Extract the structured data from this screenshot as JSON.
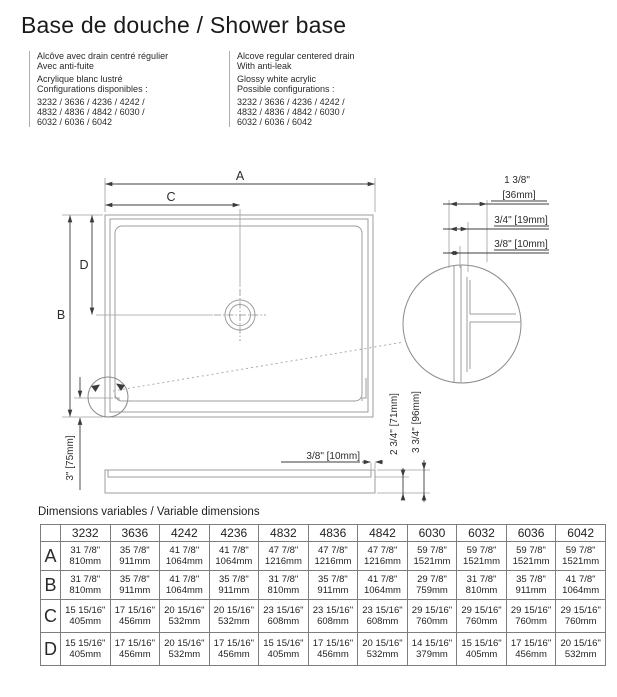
{
  "header": {
    "title": "Base de douche / Shower base",
    "col_fr": {
      "lines": [
        "Alcôve avec drain centré régulier",
        "Avec anti-fuite",
        "Acrylique blanc lustré",
        "Configurations disponibles :",
        "3232 / 3636 / 4236 / 4242 /",
        "4832 / 4836 / 4842 / 6030 /",
        "6032 / 6036 / 6042"
      ]
    },
    "col_en": {
      "lines": [
        "Alcove regular centered drain",
        "With anti-leak",
        "Glossy white acrylic",
        "Possible configurations :",
        "3232 / 3636 / 4236 / 4242 /",
        "4832 / 4836 / 4842 / 6030 /",
        "6032 / 6036 / 6042"
      ]
    }
  },
  "diagram": {
    "labels": {
      "a": "A",
      "b": "B",
      "c": "C",
      "d": "D"
    },
    "detail": {
      "dim1_top": "1 3/8\"",
      "dim1_bottom": "[36mm]",
      "dim2": "3/4\" [19mm]",
      "dim3": "3/8\" [10mm]"
    },
    "side": {
      "lip": "3/8\" [10mm]",
      "left": "3\" [75mm]",
      "inner": "2 3/4\" [71mm]",
      "outer": "3 3/4\" [96mm]"
    }
  },
  "table": {
    "caption": "Dimensions variables / Variable dimensions",
    "columns": [
      "3232",
      "3636",
      "4242",
      "4236",
      "4832",
      "4836",
      "4842",
      "6030",
      "6032",
      "6036",
      "6042"
    ],
    "rows": [
      {
        "label": "A",
        "cells": [
          {
            "in": "31 7/8\"",
            "mm": "810mm"
          },
          {
            "in": "35 7/8\"",
            "mm": "911mm"
          },
          {
            "in": "41 7/8\"",
            "mm": "1064mm"
          },
          {
            "in": "41 7/8\"",
            "mm": "1064mm"
          },
          {
            "in": "47 7/8\"",
            "mm": "1216mm"
          },
          {
            "in": "47 7/8\"",
            "mm": "1216mm"
          },
          {
            "in": "47 7/8\"",
            "mm": "1216mm"
          },
          {
            "in": "59 7/8\"",
            "mm": "1521mm"
          },
          {
            "in": "59 7/8\"",
            "mm": "1521mm"
          },
          {
            "in": "59 7/8\"",
            "mm": "1521mm"
          },
          {
            "in": "59 7/8\"",
            "mm": "1521mm"
          }
        ]
      },
      {
        "label": "B",
        "cells": [
          {
            "in": "31 7/8\"",
            "mm": "810mm"
          },
          {
            "in": "35 7/8\"",
            "mm": "911mm"
          },
          {
            "in": "41 7/8\"",
            "mm": "1064mm"
          },
          {
            "in": "35 7/8\"",
            "mm": "911mm"
          },
          {
            "in": "31 7/8\"",
            "mm": "810mm"
          },
          {
            "in": "35 7/8\"",
            "mm": "911mm"
          },
          {
            "in": "41 7/8\"",
            "mm": "1064mm"
          },
          {
            "in": "29 7/8\"",
            "mm": "759mm"
          },
          {
            "in": "31 7/8\"",
            "mm": "810mm"
          },
          {
            "in": "35 7/8\"",
            "mm": "911mm"
          },
          {
            "in": "41 7/8\"",
            "mm": "1064mm"
          }
        ]
      },
      {
        "label": "C",
        "cells": [
          {
            "in": "15 15/16\"",
            "mm": "405mm"
          },
          {
            "in": "17 15/16\"",
            "mm": "456mm"
          },
          {
            "in": "20 15/16\"",
            "mm": "532mm"
          },
          {
            "in": "20 15/16\"",
            "mm": "532mm"
          },
          {
            "in": "23 15/16\"",
            "mm": "608mm"
          },
          {
            "in": "23 15/16\"",
            "mm": "608mm"
          },
          {
            "in": "23 15/16\"",
            "mm": "608mm"
          },
          {
            "in": "29 15/16\"",
            "mm": "760mm"
          },
          {
            "in": "29 15/16\"",
            "mm": "760mm"
          },
          {
            "in": "29 15/16\"",
            "mm": "760mm"
          },
          {
            "in": "29 15/16\"",
            "mm": "760mm"
          }
        ]
      },
      {
        "label": "D",
        "cells": [
          {
            "in": "15 15/16\"",
            "mm": "405mm"
          },
          {
            "in": "17 15/16\"",
            "mm": "456mm"
          },
          {
            "in": "20 15/16\"",
            "mm": "532mm"
          },
          {
            "in": "17 15/16\"",
            "mm": "456mm"
          },
          {
            "in": "15 15/16\"",
            "mm": "405mm"
          },
          {
            "in": "17 15/16\"",
            "mm": "456mm"
          },
          {
            "in": "20 15/16\"",
            "mm": "532mm"
          },
          {
            "in": "14 15/16\"",
            "mm": "379mm"
          },
          {
            "in": "15 15/16\"",
            "mm": "405mm"
          },
          {
            "in": "17 15/16\"",
            "mm": "456mm"
          },
          {
            "in": "20 15/16\"",
            "mm": "532mm"
          }
        ]
      }
    ]
  }
}
